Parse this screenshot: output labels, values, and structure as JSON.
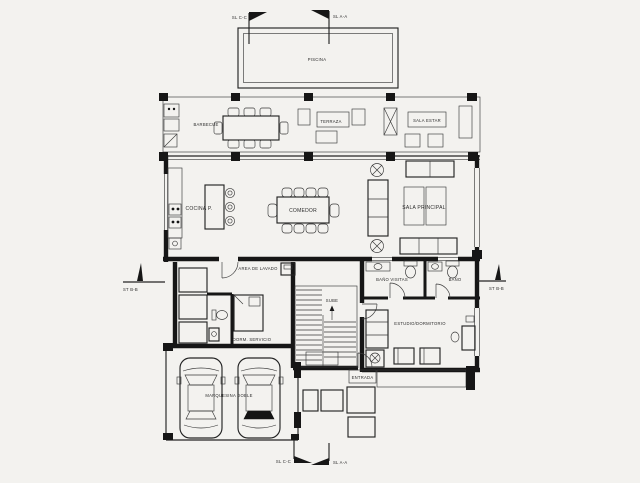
{
  "plan": {
    "rooms": {
      "piscina": "Piscina",
      "barbecue": "Barbecue",
      "terraza": "Terraza",
      "sala_estar": "Sala Estar",
      "cocina": "Cocina P.",
      "comedor": "Comedor",
      "sala_principal": "Sala Principal",
      "area_lavado": "Area de Lavado",
      "dorm_servicio": "Dorm. Servicio",
      "bano_visitas": "Baño Visitas",
      "bano": "Baño",
      "estudio_dormitorio": "Estudio/Dormitorio",
      "sube": "Sube",
      "entrada": "Entrada",
      "marquesina": "Marquesina Doble"
    },
    "markers": {
      "top_cc": "SL C-C",
      "top_aa": "SL A-A",
      "bottom_cc": "SL C-C",
      "bottom_aa": "SL A-A",
      "side_left": "ST B-B",
      "side_right": "ST B-B"
    },
    "colors": {
      "line": "#161616",
      "background": "#f3f2ef",
      "brick_joint": "#8f8f8f"
    }
  }
}
